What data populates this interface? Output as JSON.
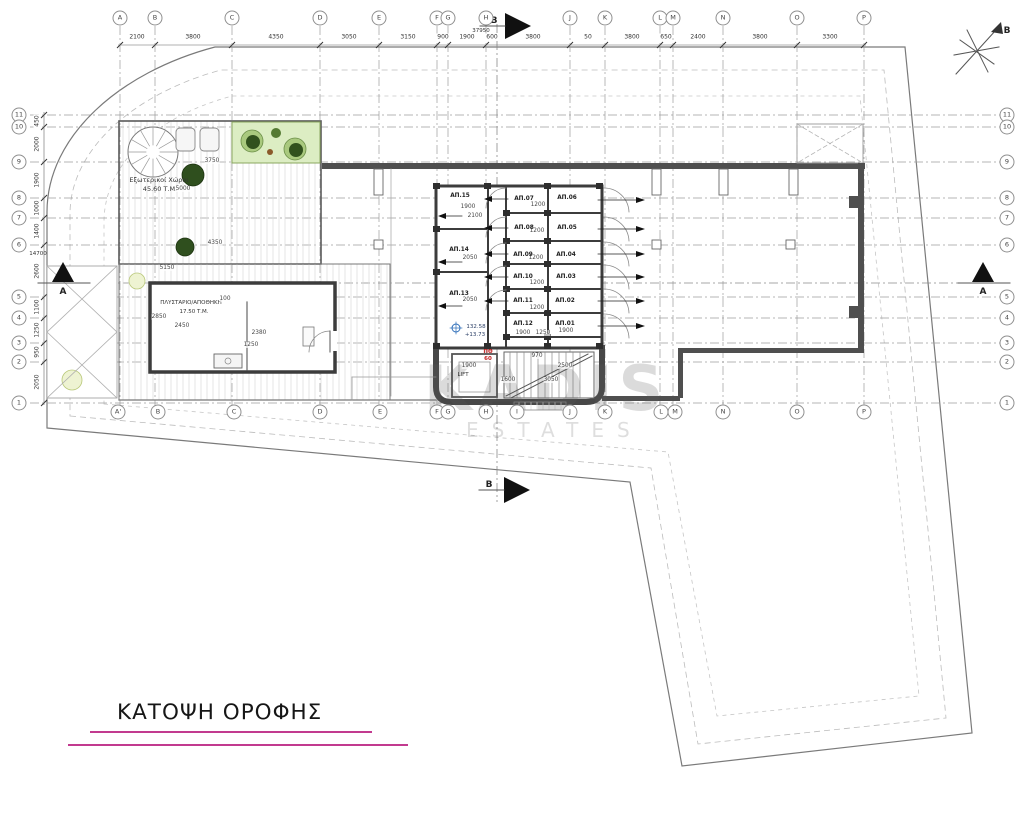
{
  "document": {
    "title": "ΚΑΤΟΨΗ ΟΡΟΦΗΣ",
    "watermark_line1": "KADIS",
    "watermark_line2": "ESTATES",
    "accent_underline_color": "#c23a8f"
  },
  "north_label": "B",
  "markers": {
    "a": "A",
    "b": "B"
  },
  "totals": {
    "horizontal": "37950",
    "vertical": "14700"
  },
  "grid": {
    "top": [
      {
        "label": "A",
        "x": 120
      },
      {
        "label": "B",
        "x": 155
      },
      {
        "label": "C",
        "x": 232
      },
      {
        "label": "D",
        "x": 320
      },
      {
        "label": "E",
        "x": 379
      },
      {
        "label": "F",
        "x": 437
      },
      {
        "label": "G",
        "x": 448
      },
      {
        "label": "H",
        "x": 486
      },
      {
        "label": "J",
        "x": 570
      },
      {
        "label": "K",
        "x": 605
      },
      {
        "label": "L",
        "x": 660
      },
      {
        "label": "M",
        "x": 673
      },
      {
        "label": "N",
        "x": 723
      },
      {
        "label": "O",
        "x": 797
      },
      {
        "label": "P",
        "x": 864
      }
    ],
    "bottom": [
      {
        "label": "A'",
        "x": 118
      },
      {
        "label": "B",
        "x": 158
      },
      {
        "label": "C",
        "x": 234
      },
      {
        "label": "D",
        "x": 320
      },
      {
        "label": "E",
        "x": 380
      },
      {
        "label": "F",
        "x": 437
      },
      {
        "label": "G",
        "x": 448
      },
      {
        "label": "H",
        "x": 486
      },
      {
        "label": "I",
        "x": 517
      },
      {
        "label": "J",
        "x": 570
      },
      {
        "label": "K",
        "x": 605
      },
      {
        "label": "L",
        "x": 661
      },
      {
        "label": "M",
        "x": 675
      },
      {
        "label": "N",
        "x": 723
      },
      {
        "label": "O",
        "x": 797
      },
      {
        "label": "P",
        "x": 864
      }
    ],
    "left": [
      {
        "label": "11",
        "y": 115
      },
      {
        "label": "10",
        "y": 127
      },
      {
        "label": "9",
        "y": 162
      },
      {
        "label": "8",
        "y": 198
      },
      {
        "label": "7",
        "y": 218
      },
      {
        "label": "6",
        "y": 245
      },
      {
        "label": "5",
        "y": 297
      },
      {
        "label": "4",
        "y": 318
      },
      {
        "label": "3",
        "y": 343
      },
      {
        "label": "2",
        "y": 362
      },
      {
        "label": "1",
        "y": 403
      }
    ],
    "right": [
      {
        "label": "11",
        "y": 115
      },
      {
        "label": "10",
        "y": 127
      },
      {
        "label": "9",
        "y": 162
      },
      {
        "label": "8",
        "y": 198
      },
      {
        "label": "7",
        "y": 218
      },
      {
        "label": "6",
        "y": 245
      },
      {
        "label": "5",
        "y": 297
      },
      {
        "label": "4",
        "y": 318
      },
      {
        "label": "3",
        "y": 343
      },
      {
        "label": "2",
        "y": 362
      },
      {
        "label": "1",
        "y": 403
      }
    ],
    "top_dims": [
      {
        "text": "2100",
        "x": 137
      },
      {
        "text": "3800",
        "x": 193
      },
      {
        "text": "4350",
        "x": 276
      },
      {
        "text": "3050",
        "x": 349
      },
      {
        "text": "3150",
        "x": 408
      },
      {
        "text": "900",
        "x": 443
      },
      {
        "text": "1900",
        "x": 467
      },
      {
        "text": "600",
        "x": 492
      },
      {
        "text": "3800",
        "x": 533
      },
      {
        "text": "50",
        "x": 588
      },
      {
        "text": "3800",
        "x": 632
      },
      {
        "text": "650",
        "x": 666
      },
      {
        "text": "2400",
        "x": 698
      },
      {
        "text": "3800",
        "x": 760
      },
      {
        "text": "3300",
        "x": 830
      }
    ],
    "left_dims": [
      {
        "text": "450",
        "y": 121
      },
      {
        "text": "2000",
        "y": 144
      },
      {
        "text": "1900",
        "y": 180
      },
      {
        "text": "1000",
        "y": 208
      },
      {
        "text": "1400",
        "y": 231
      },
      {
        "text": "2600",
        "y": 271
      },
      {
        "text": "1100",
        "y": 307
      },
      {
        "text": "1250",
        "y": 330
      },
      {
        "text": "950",
        "y": 352
      },
      {
        "text": "2050",
        "y": 382
      }
    ]
  },
  "rooms": {
    "exterior": {
      "name": "Εξωτερικοί Χώροι",
      "area": "45.60 Τ.Μ."
    },
    "laundry": {
      "name": "ΠΛΥΣΤΑΡΙΟ/ΑΠΟΘΗΚΗ",
      "area": "17.50 Τ.Μ."
    },
    "lift": {
      "name": "LIFT"
    }
  },
  "level_marker": {
    "value1": "132.58",
    "value2": "+13.73"
  },
  "fire_label": {
    "line1": "ΠΘ",
    "line2": "60"
  },
  "storage_units": [
    {
      "label": "ΑΠ.15",
      "x": 460,
      "y": 196
    },
    {
      "label": "ΑΠ.14",
      "x": 459,
      "y": 250
    },
    {
      "label": "ΑΠ.13",
      "x": 459,
      "y": 294
    },
    {
      "label": "ΑΠ.07",
      "x": 524,
      "y": 199
    },
    {
      "label": "ΑΠ.08",
      "x": 524,
      "y": 228
    },
    {
      "label": "ΑΠ.09",
      "x": 523,
      "y": 255
    },
    {
      "label": "ΑΠ.10",
      "x": 523,
      "y": 277
    },
    {
      "label": "ΑΠ.11",
      "x": 523,
      "y": 301
    },
    {
      "label": "ΑΠ.12",
      "x": 523,
      "y": 324
    },
    {
      "label": "ΑΠ.06",
      "x": 567,
      "y": 198
    },
    {
      "label": "ΑΠ.05",
      "x": 567,
      "y": 228
    },
    {
      "label": "ΑΠ.04",
      "x": 566,
      "y": 255
    },
    {
      "label": "ΑΠ.03",
      "x": 566,
      "y": 277
    },
    {
      "label": "ΑΠ.02",
      "x": 565,
      "y": 301
    },
    {
      "label": "ΑΠ.01",
      "x": 565,
      "y": 324
    }
  ],
  "plan_dims": [
    {
      "text": "3750",
      "x": 212,
      "y": 161
    },
    {
      "text": "5000",
      "x": 183,
      "y": 189
    },
    {
      "text": "4350",
      "x": 215,
      "y": 243
    },
    {
      "text": "5150",
      "x": 167,
      "y": 268
    },
    {
      "text": "2850",
      "x": 159,
      "y": 317
    },
    {
      "text": "2450",
      "x": 182,
      "y": 326
    },
    {
      "text": "100",
      "x": 225,
      "y": 299
    },
    {
      "text": "2380",
      "x": 259,
      "y": 333
    },
    {
      "text": "1250",
      "x": 251,
      "y": 345
    },
    {
      "text": "1900",
      "x": 468,
      "y": 207
    },
    {
      "text": "2100",
      "x": 475,
      "y": 216
    },
    {
      "text": "2050",
      "x": 470,
      "y": 258
    },
    {
      "text": "2050",
      "x": 470,
      "y": 300
    },
    {
      "text": "1200",
      "x": 538,
      "y": 205
    },
    {
      "text": "1200",
      "x": 537,
      "y": 231
    },
    {
      "text": "1200",
      "x": 536,
      "y": 258
    },
    {
      "text": "1200",
      "x": 537,
      "y": 283
    },
    {
      "text": "1200",
      "x": 537,
      "y": 308
    },
    {
      "text": "1900",
      "x": 523,
      "y": 333
    },
    {
      "text": "1250",
      "x": 543,
      "y": 333
    },
    {
      "text": "1900",
      "x": 566,
      "y": 331
    },
    {
      "text": "1900",
      "x": 469,
      "y": 366
    },
    {
      "text": "1600",
      "x": 508,
      "y": 380
    },
    {
      "text": "3050",
      "x": 551,
      "y": 380
    },
    {
      "text": "2500",
      "x": 565,
      "y": 366
    },
    {
      "text": "970",
      "x": 537,
      "y": 356
    }
  ]
}
